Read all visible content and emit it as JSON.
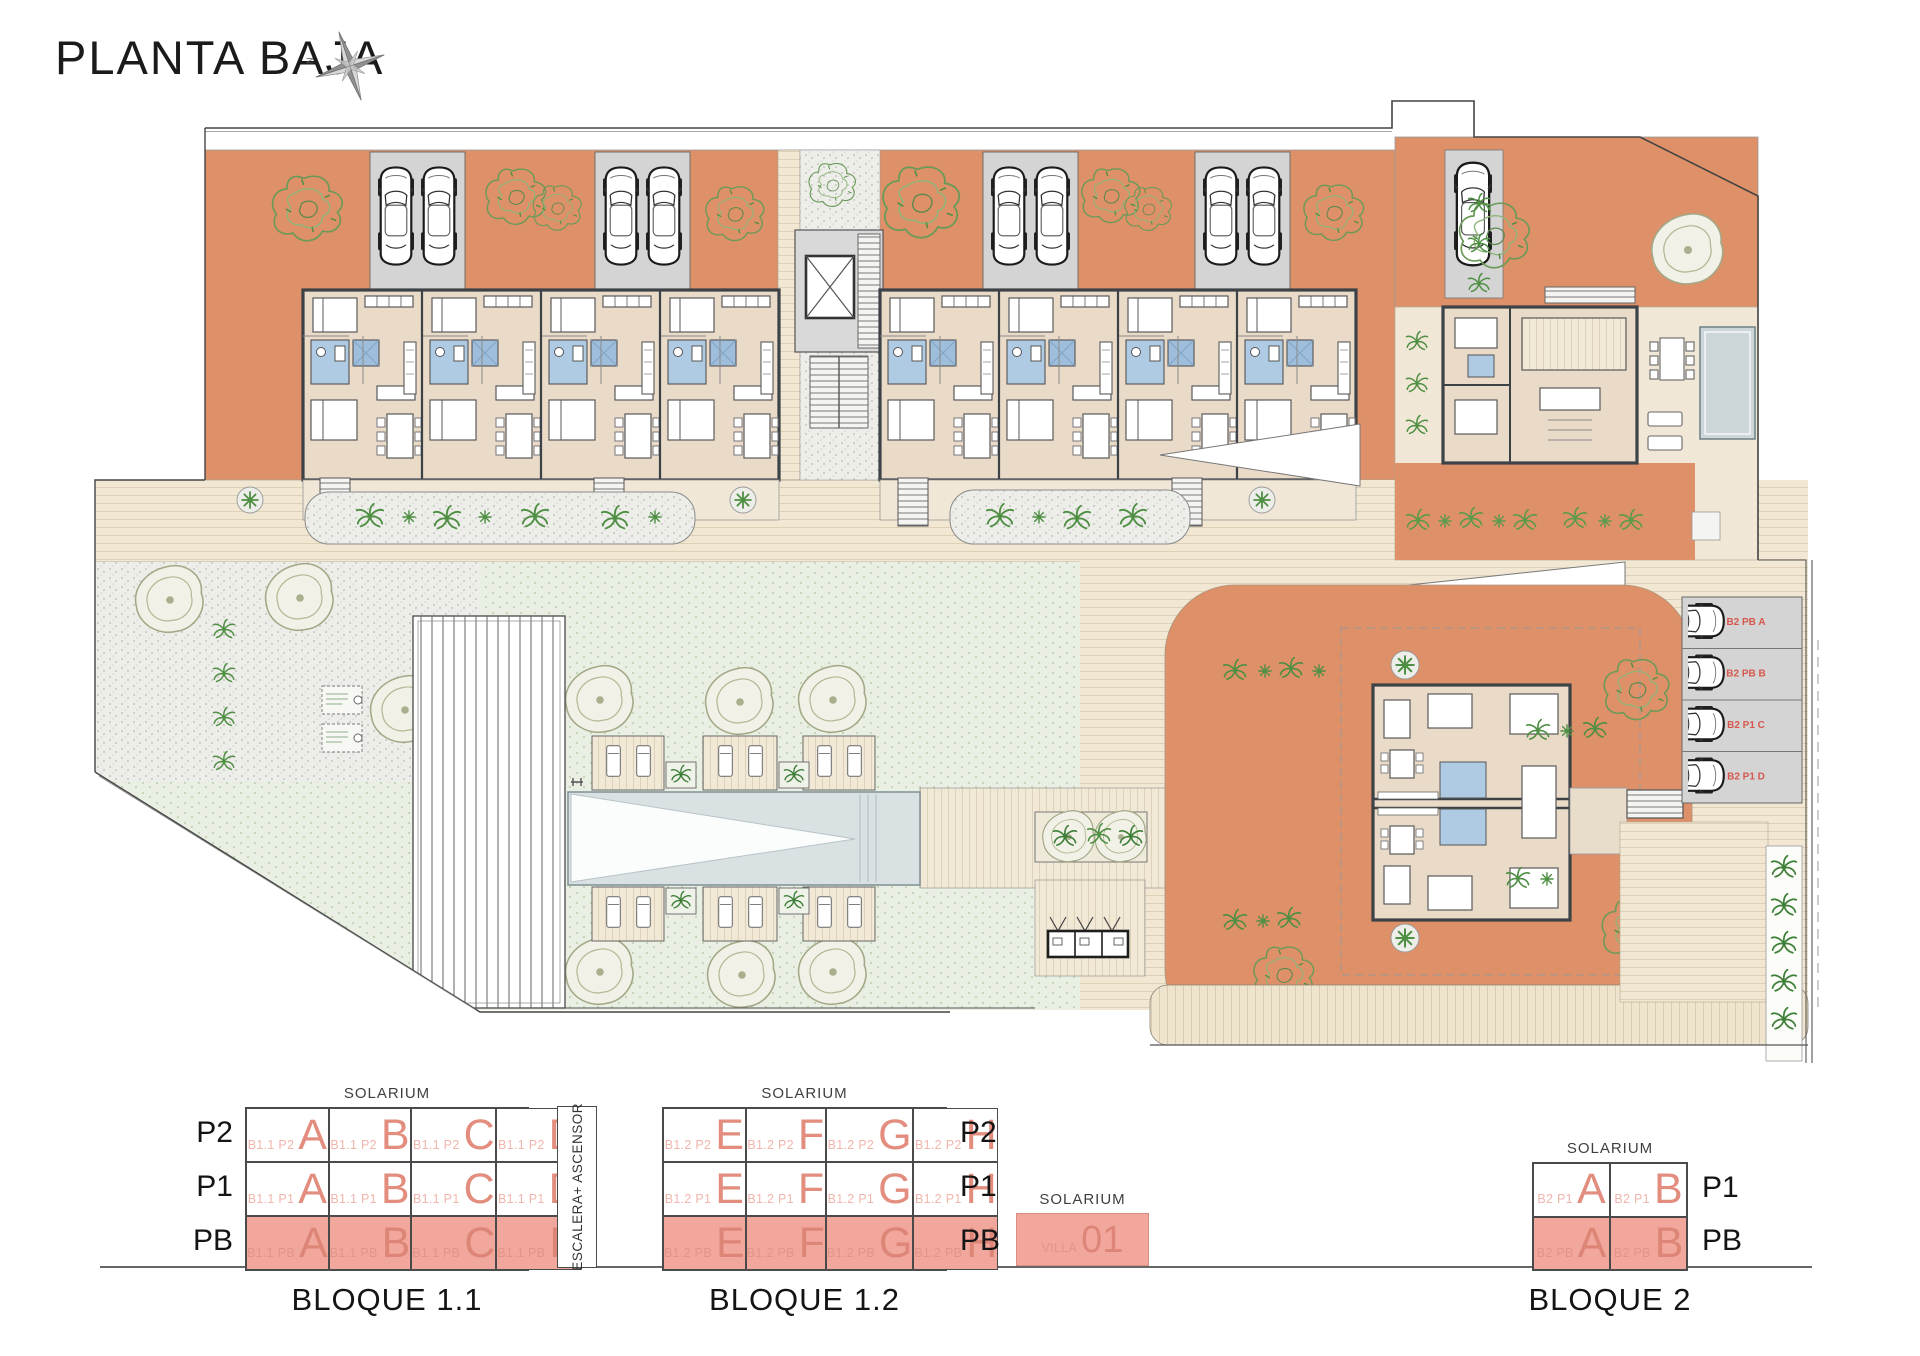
{
  "header": {
    "title": "PLANTA BAJA",
    "compass_north": "N"
  },
  "site_plan": {
    "parking_labels": [
      "B2 PB A",
      "B2 PB B",
      "B2 P1 C",
      "B2 P1 D"
    ]
  },
  "legend": {
    "solarium": "SOLARIUM",
    "escalera": "ESCALERA+ ASCENSOR",
    "bloque11": {
      "title": "BLOQUE 1.1",
      "rows": [
        {
          "floor": "P2",
          "cells": [
            {
              "prefix": "B1.1 P2",
              "letter": "A"
            },
            {
              "prefix": "B1.1 P2",
              "letter": "B"
            },
            {
              "prefix": "B1.1 P2",
              "letter": "C"
            },
            {
              "prefix": "B1.1 P2",
              "letter": "D"
            }
          ]
        },
        {
          "floor": "P1",
          "cells": [
            {
              "prefix": "B1.1 P1",
              "letter": "A"
            },
            {
              "prefix": "B1.1 P1",
              "letter": "B"
            },
            {
              "prefix": "B1.1 P1",
              "letter": "C"
            },
            {
              "prefix": "B1.1 P1",
              "letter": "D"
            }
          ]
        },
        {
          "floor": "PB",
          "cells": [
            {
              "prefix": "B1.1 PB",
              "letter": "A"
            },
            {
              "prefix": "B1.1 PB",
              "letter": "B"
            },
            {
              "prefix": "B1.1 PB",
              "letter": "C"
            },
            {
              "prefix": "B1.1 PB",
              "letter": "D"
            }
          ]
        }
      ]
    },
    "bloque12": {
      "title": "BLOQUE 1.2",
      "rows": [
        {
          "floor": "P2",
          "cells": [
            {
              "prefix": "B1.2 P2",
              "letter": "E"
            },
            {
              "prefix": "B1.2 P2",
              "letter": "F"
            },
            {
              "prefix": "B1.2 P2",
              "letter": "G"
            },
            {
              "prefix": "B1.2 P2",
              "letter": "H"
            }
          ]
        },
        {
          "floor": "P1",
          "cells": [
            {
              "prefix": "B1.2 P1",
              "letter": "E"
            },
            {
              "prefix": "B1.2 P1",
              "letter": "F"
            },
            {
              "prefix": "B1.2 P1",
              "letter": "G"
            },
            {
              "prefix": "B1.2 P1",
              "letter": "H"
            }
          ]
        },
        {
          "floor": "PB",
          "cells": [
            {
              "prefix": "B1.2 PB",
              "letter": "E"
            },
            {
              "prefix": "B1.2 PB",
              "letter": "F"
            },
            {
              "prefix": "B1.2 PB",
              "letter": "G"
            },
            {
              "prefix": "B1.2 PB",
              "letter": "H"
            }
          ]
        }
      ]
    },
    "villa": {
      "solarium": "SOLARIUM",
      "prefix": "VILLA",
      "number": "01"
    },
    "bloque2": {
      "title": "BLOQUE 2",
      "rows": [
        {
          "floor": "P1",
          "cells": [
            {
              "prefix": "B2 P1",
              "letter": "A"
            },
            {
              "prefix": "B2 P1",
              "letter": "B"
            }
          ]
        },
        {
          "floor": "PB",
          "cells": [
            {
              "prefix": "B2 PB",
              "letter": "A"
            },
            {
              "prefix": "B2 PB",
              "letter": "B"
            }
          ]
        }
      ]
    }
  }
}
